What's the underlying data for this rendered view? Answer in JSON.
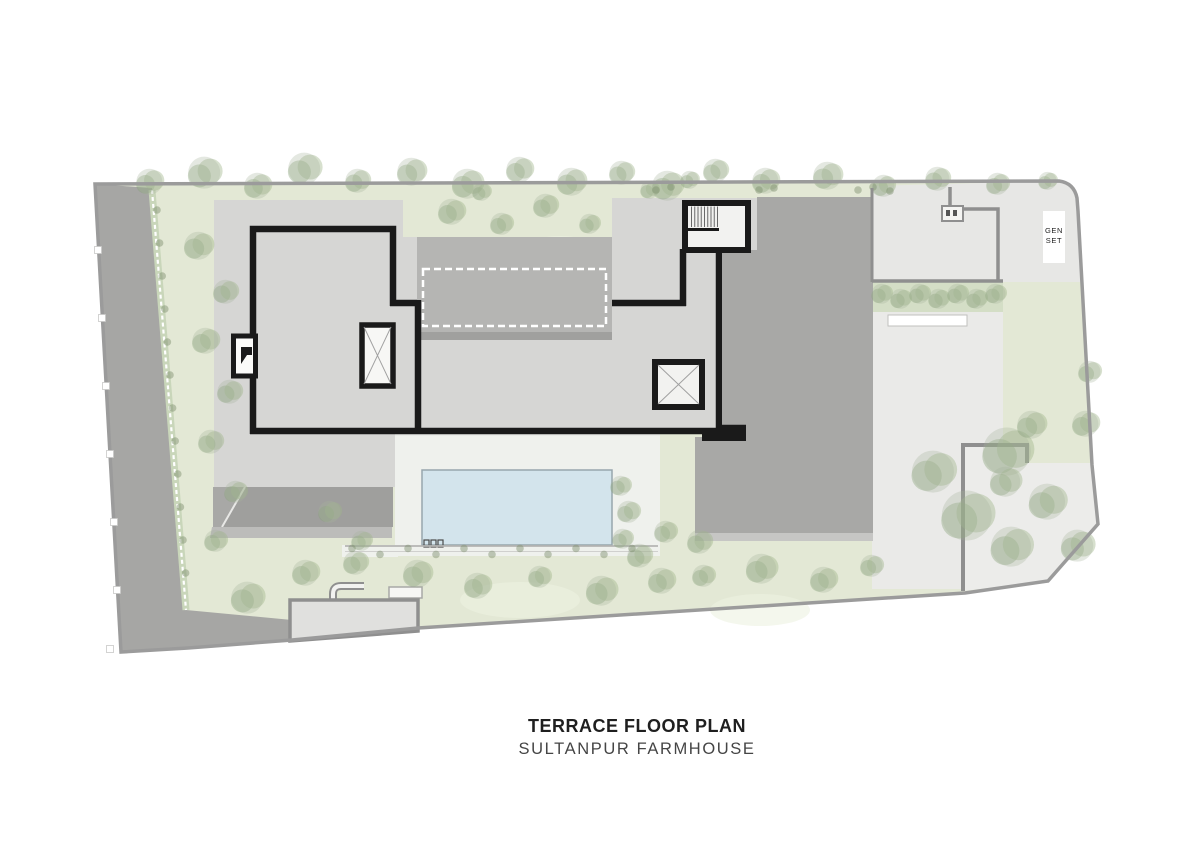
{
  "page": {
    "background": "#ffffff"
  },
  "title_block": {
    "line1": "TERRACE FLOOR PLAN",
    "line2": "SULTANPUR FARMHOUSE"
  },
  "plan_labels": {
    "gen_set": [
      "GEN",
      "SET"
    ]
  },
  "colors": {
    "page_bg": "#ffffff",
    "lawn": "#e3e8d5",
    "lawn_patch": "#edf1e1",
    "road": "#a6a6a4",
    "hedge_band": "#c9d6ba",
    "terrace": "#d6d6d4",
    "apron": "#e9ebe7",
    "deck": "#eff1ed",
    "pool_water": "#d3e4ec",
    "pool_edge": "#97a6ad",
    "roof_dark": "#a8a8a6",
    "roof_block": "#b5b5b3",
    "roof_shadow": "#a0a09e",
    "canopy": "#9f9f9d",
    "canopy_left": "#a8a8a6",
    "canopy_shadow": "#bcbcba",
    "gatehouse": "#e0e0de",
    "yard_top": "#e7e7e5",
    "yard_paved": "#eaeae8",
    "yard_service": "#ececea",
    "wall_black": "#1a1a1a",
    "wall_gray": "#8f8f8f",
    "boundary": "#9b9b9b",
    "tree_green": "#9fb58a",
    "tree_olive": "#87a075",
    "tree_gray": "#a7b29c",
    "shrub_dark": "#7d8e6d",
    "white_box": "#ffffff",
    "text_dark": "#1f1f1f",
    "text_sub": "#454545"
  }
}
